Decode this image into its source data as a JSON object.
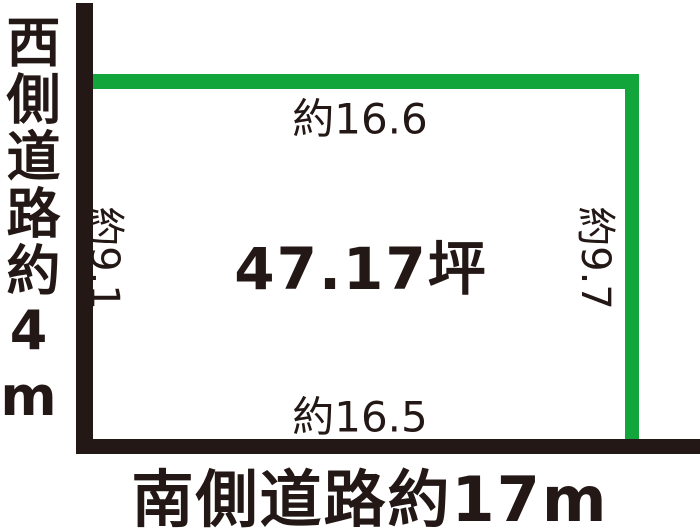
{
  "diagram": {
    "title_semantic": "land-plot-survey-diagram",
    "colors": {
      "ink": "#231815",
      "boundary_green": "#12a53c",
      "background": "#ffffff"
    },
    "roads": {
      "west_label": "西側道路約4m",
      "south_label": "南側道路約17m"
    },
    "dimensions": {
      "north": "約16.6",
      "south": "約16.5",
      "west": "約9.1",
      "east": "約9.7"
    },
    "area_label": "47.17坪"
  }
}
